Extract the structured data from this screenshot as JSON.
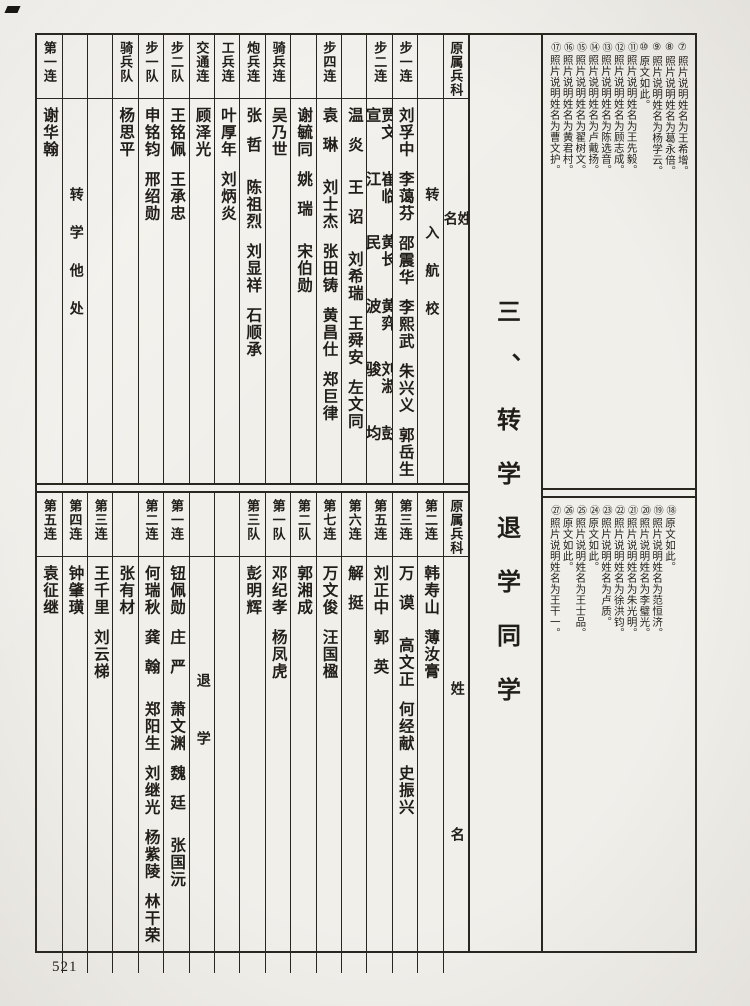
{
  "page": {
    "number": "521",
    "section_title": "三、转学退学同学"
  },
  "tables": {
    "top": {
      "corner_header": "原属兵科",
      "body_axis_label": "姓名",
      "columns_right_to_left": [
        {
          "type": "axis",
          "unit": "原属兵科",
          "label": "姓名"
        },
        {
          "type": "annotation",
          "unit": "",
          "text": "转入航校"
        },
        {
          "unit": "步一连",
          "names": [
            "刘孚中",
            "李蔼芬",
            "邵震华",
            "李熙武",
            "朱兴义",
            "郭岳生"
          ]
        },
        {
          "unit": "步二连",
          "names": [
            "贾文宣",
            "崔临江",
            "黄长民",
            "黄弈波",
            "刘淑骏",
            "彭均"
          ]
        },
        {
          "unit": "",
          "names": [
            "温炎",
            "王诏",
            "刘希瑞",
            "王舜安",
            "左文同"
          ]
        },
        {
          "unit": "步四连",
          "names": [
            "袁琳",
            "刘士杰",
            "张田铸",
            "黄昌仕",
            "郑巨律"
          ]
        },
        {
          "unit": "",
          "names": [
            "谢毓同",
            "姚瑞",
            "宋伯勋"
          ]
        },
        {
          "unit": "骑兵连",
          "names": [
            "吴乃世"
          ]
        },
        {
          "unit": "炮兵连",
          "names": [
            "张哲",
            "陈祖烈",
            "刘显祥",
            "石顺承"
          ]
        },
        {
          "unit": "工兵连",
          "names": [
            "叶厚年",
            "刘炳炎"
          ]
        },
        {
          "unit": "交通连",
          "names": [
            "顾泽光"
          ]
        },
        {
          "unit": "步二队",
          "names": [
            "王铭佩",
            "王承忠"
          ]
        },
        {
          "unit": "步一队",
          "names": [
            "申铭钧",
            "邢绍勋"
          ]
        },
        {
          "unit": "骑兵队",
          "names": [
            "杨思平"
          ]
        },
        {
          "unit": "",
          "names": []
        },
        {
          "type": "annotation",
          "unit": "",
          "text": "转学他处"
        },
        {
          "unit": "第一连",
          "names": [
            "谢华翰"
          ]
        }
      ]
    },
    "bottom": {
      "corner_header": "原属兵科",
      "body_axis_label": "姓名",
      "columns_right_to_left": [
        {
          "type": "axis",
          "unit": "原属兵科",
          "label": "姓名"
        },
        {
          "unit": "第二连",
          "names": [
            "韩寿山",
            "薄汝膏"
          ]
        },
        {
          "unit": "第三连",
          "names": [
            "万谟",
            "高文正",
            "何经献",
            "史振兴"
          ]
        },
        {
          "unit": "第五连",
          "names": [
            "刘正中",
            "郭英"
          ]
        },
        {
          "unit": "第六连",
          "names": [
            "解挺"
          ]
        },
        {
          "unit": "第七连",
          "names": [
            "万文俊",
            "汪国楹"
          ]
        },
        {
          "unit": "第二队",
          "names": [
            "郭湘成"
          ]
        },
        {
          "unit": "第一队",
          "names": [
            "邓纪孝",
            "杨凤虎"
          ]
        },
        {
          "unit": "第三队",
          "names": [
            "彭明辉"
          ]
        },
        {
          "unit": "",
          "names": []
        },
        {
          "type": "annotation",
          "unit": "",
          "text": "退学"
        },
        {
          "unit": "第一连",
          "names": [
            "钮佩勋",
            "庄严",
            "萧文渊",
            "魏廷",
            "张国沅"
          ]
        },
        {
          "unit": "第二连",
          "names": [
            "何瑞秋",
            "龚翰",
            "郑阳生",
            "刘继光",
            "杨紫陵",
            "林干荣"
          ]
        },
        {
          "unit": "",
          "names": [
            "张有材"
          ]
        },
        {
          "unit": "第三连",
          "names": [
            "王千里",
            "刘云梯"
          ]
        },
        {
          "unit": "第四连",
          "names": [
            "钟肇璜"
          ]
        },
        {
          "unit": "第五连",
          "names": [
            "袁征继"
          ]
        }
      ]
    }
  },
  "footnotes": {
    "top": [
      {
        "marker": "⑦",
        "text": "照片说明姓名为王希增。"
      },
      {
        "marker": "⑧",
        "text": "照片说明姓名为葛永倍。"
      },
      {
        "marker": "⑨",
        "text": "照片说明姓名为杨学云。"
      },
      {
        "marker": "⑩",
        "text": "原文如此。"
      },
      {
        "marker": "⑪",
        "text": "照片说明姓名为王先毅。"
      },
      {
        "marker": "⑫",
        "text": "照片说明姓名为顾志成。"
      },
      {
        "marker": "⑬",
        "text": "照片说明姓名为陈选音。"
      },
      {
        "marker": "⑭",
        "text": "照片说明姓名为卢戴扬。"
      },
      {
        "marker": "⑮",
        "text": "照片说明姓名为翟树文。"
      },
      {
        "marker": "⑯",
        "text": "照片说明姓名为黄君村。"
      },
      {
        "marker": "⑰",
        "text": "照片说明姓名为曹文护。"
      }
    ],
    "bottom": [
      {
        "marker": "⑱",
        "text": "原文如此。"
      },
      {
        "marker": "⑲",
        "text": "照片说明姓名为范恒济。"
      },
      {
        "marker": "⑳",
        "text": "照片说明姓名为李璧光。"
      },
      {
        "marker": "㉑",
        "text": "照片说明姓名为朱光明。"
      },
      {
        "marker": "㉒",
        "text": "照片说明姓名为徐洪钧。"
      },
      {
        "marker": "㉓",
        "text": "照片说明姓名为卢质。"
      },
      {
        "marker": "㉔",
        "text": "原文如此。"
      },
      {
        "marker": "㉕",
        "text": "照片说明姓名为王士品。"
      },
      {
        "marker": "㉖",
        "text": "原文如此。"
      },
      {
        "marker": "㉗",
        "text": "照片说明姓名为王干一。"
      }
    ]
  }
}
